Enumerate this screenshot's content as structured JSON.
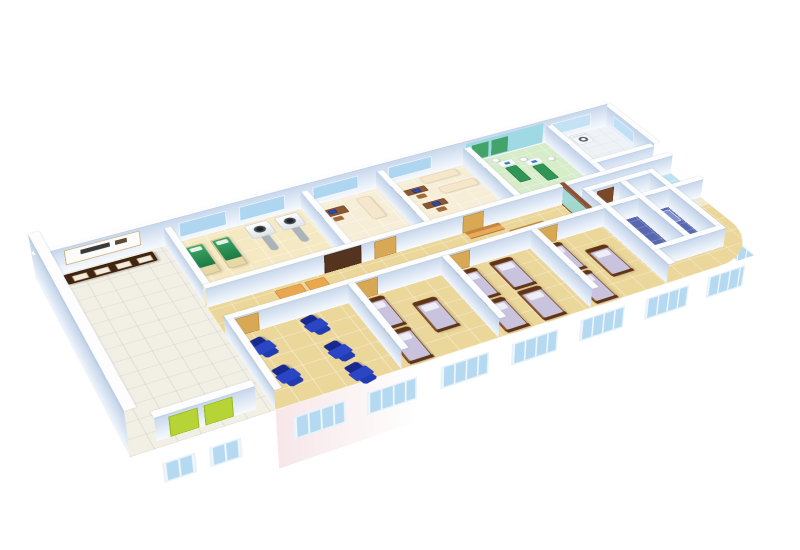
{
  "scene": {
    "background": "#ffffff",
    "camera": {
      "perspective": 1500,
      "rotate_x": 56,
      "rotate_z": -27,
      "scale": 0.88,
      "offset_y": -18,
      "origin": "50% 42%"
    }
  },
  "palette": {
    "wall_top": "#fdfdfe",
    "wall_face_h": [
      "#f8fbff",
      "#c7d7ec"
    ],
    "wall_face_v": [
      "#f2f7fd",
      "#bfd1e8"
    ],
    "floor_tan": "#ecd79b",
    "floor_lobby": "#f2efe4",
    "floor_physio": "#d7ecc9",
    "floor_bath": "#5767b0",
    "glass_blue": "#aed6f0",
    "door_tan": "#d9a855",
    "door_dark": "#54341e",
    "recliner_blue": "#2a46c4",
    "bed_wood": "#8a5a33",
    "bed_mattress": "#c9c3de",
    "exam_green": "#2f9658",
    "elevator_green": "#b6d435",
    "facade_pink": "#f7e7e9",
    "counter_glass": "#9fc6e6"
  },
  "plan": {
    "width": 760,
    "height": 360,
    "wall_height": 26
  },
  "floors": [
    {
      "name": "floor-main-wing",
      "x": 150,
      "y": 30,
      "w": 610,
      "h": 330,
      "color": "#ecd79b",
      "radius": "0 0 70px 0",
      "grid": {
        "c": "rgba(255,255,255,0.45)",
        "s": 26
      }
    },
    {
      "name": "floor-lobby",
      "x": 0,
      "y": 30,
      "w": 150,
      "h": 330,
      "color": "#f2efe4",
      "grid": {
        "c": "rgba(160,170,185,0.25)",
        "s": 24
      }
    },
    {
      "name": "floor-treatment-room",
      "x": 150,
      "y": 30,
      "w": 170,
      "h": 133,
      "color": "#f5e9c4",
      "grid": {
        "c": "rgba(255,255,255,0.5)",
        "s": 24
      }
    },
    {
      "name": "floor-consult-office",
      "x": 320,
      "y": 30,
      "w": 100,
      "h": 133,
      "color": "#f7eed8",
      "grid": {
        "c": "rgba(255,255,255,0.5)",
        "s": 24
      }
    },
    {
      "name": "floor-exam-room",
      "x": 420,
      "y": 30,
      "w": 120,
      "h": 133,
      "color": "#f7eed8",
      "grid": {
        "c": "rgba(255,255,255,0.5)",
        "s": 24
      }
    },
    {
      "name": "floor-physio-room",
      "x": 540,
      "y": 30,
      "w": 120,
      "h": 133,
      "color": "#d7ecc9",
      "grid": {
        "c": "rgba(255,255,255,0.5)",
        "s": 22
      }
    },
    {
      "name": "floor-lab-room",
      "x": 660,
      "y": 30,
      "w": 100,
      "h": 105,
      "color": "#eff3f6",
      "grid": {
        "c": "rgba(200,210,220,0.35)",
        "s": 20
      }
    },
    {
      "name": "floor-reception-lobby",
      "x": 660,
      "y": 135,
      "w": 100,
      "h": 115,
      "color": "#f0e9cf",
      "grid": {
        "c": "rgba(255,255,255,0.5)",
        "s": 22
      }
    },
    {
      "name": "floor-glass-bay",
      "x": 712,
      "y": 148,
      "w": 48,
      "h": 104,
      "color": "#bfe2f4",
      "radius": "0 30px 70px 0",
      "grid": {
        "c": "rgba(255,255,255,0.5)",
        "s": 16
      }
    },
    {
      "name": "floor-bathrooms",
      "x": 620,
      "y": 185,
      "w": 100,
      "h": 145,
      "color": "#5767b0",
      "grid": {
        "c": "rgba(255,255,255,0.28)",
        "s": 15
      }
    }
  ],
  "walls": [
    {
      "n": "wall-exterior-left",
      "o": "v",
      "u": 0,
      "v": 30,
      "len": 330,
      "t": 12,
      "H": 58
    },
    {
      "n": "wall-exterior-back",
      "o": "h",
      "u": 0,
      "v": 30,
      "len": 752,
      "t": 8,
      "H": 34
    },
    {
      "n": "wall-lobby-right-upper",
      "o": "v",
      "u": 150,
      "v": 30,
      "len": 133
    },
    {
      "n": "wall-lobby-right-lower",
      "o": "v",
      "u": 150,
      "v": 225,
      "len": 135
    },
    {
      "n": "wall-corridor-back",
      "o": "h",
      "u": 150,
      "v": 163,
      "len": 610,
      "t": 8
    },
    {
      "n": "wall-corridor-front",
      "o": "h",
      "u": 150,
      "v": 225,
      "len": 610,
      "t": 8
    },
    {
      "n": "wall-div-treatment-office",
      "o": "v",
      "u": 320,
      "v": 30,
      "len": 133
    },
    {
      "n": "wall-div-office-exam",
      "o": "v",
      "u": 420,
      "v": 30,
      "len": 133
    },
    {
      "n": "wall-div-exam-physio",
      "o": "v",
      "u": 540,
      "v": 30,
      "len": 133
    },
    {
      "n": "wall-div-physio-lab",
      "o": "v",
      "u": 660,
      "v": 30,
      "len": 133
    },
    {
      "n": "wall-lab-reception",
      "o": "h",
      "u": 660,
      "v": 135,
      "len": 92,
      "t": 8
    },
    {
      "n": "wall-exterior-right",
      "o": "v",
      "u": 752,
      "v": 30,
      "len": 113,
      "H": 30
    },
    {
      "n": "wall-div-infusion-ward1",
      "o": "v",
      "u": 290,
      "v": 233,
      "len": 127
    },
    {
      "n": "wall-div-ward1-ward2",
      "o": "v",
      "u": 405,
      "v": 233,
      "len": 127
    },
    {
      "n": "wall-div-ward2-ward3",
      "o": "v",
      "u": 520,
      "v": 233,
      "len": 127
    },
    {
      "n": "wall-div-ward3-bath",
      "o": "v",
      "u": 620,
      "v": 185,
      "len": 175
    },
    {
      "n": "wall-bath-back",
      "o": "h",
      "u": 620,
      "v": 185,
      "len": 100,
      "t": 8
    },
    {
      "n": "wall-bath-divider",
      "o": "v",
      "u": 668,
      "v": 193,
      "len": 137
    },
    {
      "n": "wall-bath-right",
      "o": "v",
      "u": 712,
      "v": 185,
      "len": 145
    },
    {
      "n": "wall-bath-front",
      "o": "h",
      "u": 620,
      "v": 322,
      "len": 100,
      "t": 8
    },
    {
      "n": "wall-corridor-glass-door",
      "o": "v",
      "u": 602,
      "v": 163,
      "len": 62,
      "t": 6,
      "glass": true
    },
    {
      "n": "wall-elevator-shaft",
      "o": "h",
      "u": 30,
      "v": 340,
      "len": 104,
      "t": 10,
      "H": 30
    }
  ],
  "openings": [
    {
      "n": "window-treatment-1",
      "on": "h",
      "u": 168,
      "v": 38.4,
      "len": 58,
      "z0": 6,
      "z1": 26,
      "color": "#aed6f0",
      "frame": "#f6fbff"
    },
    {
      "n": "window-treatment-2",
      "on": "h",
      "u": 242,
      "v": 38.4,
      "len": 58,
      "z0": 6,
      "z1": 26,
      "color": "#aed6f0",
      "frame": "#f6fbff"
    },
    {
      "n": "window-office",
      "on": "h",
      "u": 336,
      "v": 38.4,
      "len": 60,
      "z0": 8,
      "z1": 26,
      "color": "#aed6f0",
      "frame": "#f6fbff"
    },
    {
      "n": "window-exam",
      "on": "h",
      "u": 436,
      "v": 38.4,
      "len": 60,
      "z0": 8,
      "z1": 26,
      "color": "#aed6f0",
      "frame": "#f6fbff"
    },
    {
      "n": "glass-band-physio",
      "on": "h",
      "u": 544,
      "v": 38.4,
      "len": 112,
      "z0": 2,
      "z1": 30,
      "color": "#9ed9e4"
    },
    {
      "n": "green-panel-physio-1",
      "on": "h",
      "u": 552,
      "v": 38.7,
      "len": 24,
      "z0": 4,
      "z1": 26,
      "color": "#43a368"
    },
    {
      "n": "green-panel-physio-2",
      "on": "h",
      "u": 580,
      "v": 38.7,
      "len": 24,
      "z0": 4,
      "z1": 26,
      "color": "#43a368"
    },
    {
      "n": "window-lab",
      "on": "h",
      "u": 668,
      "v": 38.4,
      "len": 60,
      "z0": 8,
      "z1": 26,
      "color": "#c4e2f4",
      "frame": "#f6fbff"
    },
    {
      "n": "sign-registration",
      "on": "h",
      "u": 34,
      "v": 38.4,
      "len": 88,
      "z0": 10,
      "z1": 30,
      "color": "#fbfbf9",
      "frame": "#caa86a"
    },
    {
      "n": "sign-text-mark-1",
      "on": "h",
      "u": 52,
      "v": 38.8,
      "len": 34,
      "z0": 20,
      "z1": 26,
      "color": "#3a3a3a"
    },
    {
      "n": "sign-text-mark-2",
      "on": "h",
      "u": 92,
      "v": 38.8,
      "len": 14,
      "z0": 20,
      "z1": 26,
      "color": "#5a4a3a"
    },
    {
      "n": "door-treatment-double",
      "on": "h",
      "u": 290,
      "v": 171.4,
      "len": 46,
      "z0": 0,
      "z1": 25,
      "color": "#54341e",
      "frame": "#3c2412"
    },
    {
      "n": "door-office",
      "on": "h",
      "u": 352,
      "v": 171.4,
      "len": 28,
      "z0": 0,
      "z1": 24,
      "color": "#d9a855",
      "frame": "#b8863c"
    },
    {
      "n": "door-exam",
      "on": "h",
      "u": 466,
      "v": 171.4,
      "len": 28,
      "z0": 0,
      "z1": 24,
      "color": "#d9a855",
      "frame": "#b8863c"
    },
    {
      "n": "door-infusion",
      "on": "h",
      "u": 158,
      "v": 233.4,
      "len": 28,
      "z0": 0,
      "z1": 24,
      "color": "#d9a855",
      "frame": "#b8863c"
    },
    {
      "n": "door-ward1",
      "on": "h",
      "u": 298,
      "v": 233.4,
      "len": 28,
      "z0": 0,
      "z1": 24,
      "color": "#d9a855",
      "frame": "#b8863c"
    },
    {
      "n": "door-ward2",
      "on": "h",
      "u": 413,
      "v": 233.4,
      "len": 28,
      "z0": 0,
      "z1": 24,
      "color": "#d9a855",
      "frame": "#b8863c"
    },
    {
      "n": "door-ward3",
      "on": "h",
      "u": 528,
      "v": 233.4,
      "len": 28,
      "z0": 0,
      "z1": 24,
      "color": "#d9a855",
      "frame": "#b8863c"
    },
    {
      "n": "door-bathroom",
      "on": "h",
      "u": 636,
      "v": 193.4,
      "len": 24,
      "z0": 0,
      "z1": 22,
      "color": "#7a4a28",
      "frame": "#5e3418"
    },
    {
      "n": "door-elevator-left",
      "on": "h",
      "u": 44,
      "v": 350.4,
      "len": 30,
      "z0": 0,
      "z1": 26,
      "color": "#b6d435",
      "frame": "#8fb313"
    },
    {
      "n": "door-elevator-right",
      "on": "h",
      "u": 80,
      "v": 350.4,
      "len": 30,
      "z0": 0,
      "z1": 26,
      "color": "#b6d435",
      "frame": "#8fb313"
    },
    {
      "n": "glass-panel-lobby-1",
      "on": "v",
      "u": 12.4,
      "v": 150,
      "len": 48,
      "z0": 6,
      "z1": 40,
      "color": "#b7d2e8",
      "frame": "#6e4226"
    },
    {
      "n": "glass-panel-lobby-2",
      "on": "v",
      "u": 12.4,
      "v": 204,
      "len": 48,
      "z0": 6,
      "z1": 40,
      "color": "#b7d2e8",
      "frame": "#6e4226"
    },
    {
      "n": "glass-panel-lobby-3",
      "on": "v",
      "u": 12.4,
      "v": 258,
      "len": 48,
      "z0": 6,
      "z1": 40,
      "color": "#b7d2e8",
      "frame": "#6e4226"
    },
    {
      "n": "window-lab-right",
      "on": "v",
      "u": 752.4,
      "v": 54,
      "len": 46,
      "z0": 8,
      "z1": 24,
      "color": "#bfe0f6",
      "frame": "#f6fbff"
    }
  ],
  "facades": [
    {
      "n": "facade-front-main",
      "type": "h",
      "u": 150,
      "v": 360,
      "len": 610,
      "depth": 78,
      "bg": "linear-gradient(90deg,#f7e7e9 0%,#ffffff 26%,#ffffff 100%)",
      "win_color": "#b4d9f1",
      "win_frame": "#e8f2fa",
      "windows": [
        {
          "x": 18,
          "d": 16,
          "w": 58,
          "h": 30
        },
        {
          "x": 100,
          "d": 16,
          "w": 58,
          "h": 30
        },
        {
          "x": 186,
          "d": 14,
          "w": 58,
          "h": 30
        },
        {
          "x": 272,
          "d": 14,
          "w": 58,
          "h": 30
        },
        {
          "x": 358,
          "d": 12,
          "w": 58,
          "h": 30
        },
        {
          "x": 444,
          "d": 12,
          "w": 58,
          "h": 30
        },
        {
          "x": 528,
          "d": 10,
          "w": 52,
          "h": 30
        }
      ]
    },
    {
      "n": "facade-front-lobby",
      "type": "h",
      "u": 0,
      "v": 360,
      "len": 150,
      "depth": 78,
      "bg": "#ffffff",
      "win_color": "#b4d9f1",
      "win_frame": "#e8f2fa",
      "windows": [
        {
          "x": 30,
          "d": 20,
          "w": 34,
          "h": 26
        },
        {
          "x": 78,
          "d": 20,
          "w": 34,
          "h": 26
        }
      ]
    },
    {
      "n": "facade-right-end",
      "type": "v",
      "u": 760,
      "v": 135,
      "len": 225,
      "depth": 78,
      "bg": "#ffffff",
      "win_color": "#b4d9f1",
      "win_frame": "#e8f2fa",
      "windows": [
        {
          "y": 24,
          "d": 14,
          "w": 48,
          "h": 28
        },
        {
          "y": 96,
          "d": 14,
          "w": 48,
          "h": 28
        },
        {
          "y": 168,
          "d": 18,
          "w": 40,
          "h": 26
        }
      ]
    }
  ],
  "furniture": [
    {
      "t": "counter",
      "n": "registration-counter",
      "x": 28,
      "y": 44
    },
    {
      "t": "gbed",
      "n": "exam-bed-green-1",
      "x": 166,
      "y": 54
    },
    {
      "t": "gbed",
      "n": "exam-bed-green-2",
      "x": 198,
      "y": 54
    },
    {
      "t": "scan",
      "n": "scanner-machine-1",
      "x": 244,
      "y": 44
    },
    {
      "t": "scan",
      "n": "scanner-machine-2",
      "x": 282,
      "y": 44
    },
    {
      "t": "desk",
      "n": "doctor-desk",
      "x": 330,
      "y": 56
    },
    {
      "t": "couch",
      "n": "exam-couch-office",
      "x": 386,
      "y": 50,
      "vert": true
    },
    {
      "t": "box",
      "n": "cabinet",
      "x": 424,
      "y": 44,
      "w": 14,
      "h": 66,
      "color": "#b5834e",
      "border": "#8f5f30"
    },
    {
      "t": "desk",
      "n": "pc-desk-1",
      "x": 444,
      "y": 60,
      "small": true
    },
    {
      "t": "desk",
      "n": "pc-desk-2",
      "x": 452,
      "y": 96,
      "small": true
    },
    {
      "t": "couch",
      "n": "exam-couch-1",
      "x": 476,
      "y": 42
    },
    {
      "t": "couch",
      "n": "exam-couch-2",
      "x": 486,
      "y": 72
    },
    {
      "t": "box",
      "n": "floor-mat",
      "x": 424,
      "y": 120,
      "w": 16,
      "h": 10,
      "color": "#7cc87c"
    },
    {
      "t": "ptable",
      "n": "physio-table-1",
      "x": 550,
      "y": 50
    },
    {
      "t": "ptable",
      "n": "physio-table-2",
      "x": 582,
      "y": 62
    },
    {
      "t": "ptable",
      "n": "physio-table-3",
      "x": 614,
      "y": 74
    },
    {
      "t": "staff",
      "n": "staff-figure-1",
      "x": 576,
      "y": 44
    },
    {
      "t": "staff",
      "n": "staff-figure-2",
      "x": 608,
      "y": 58
    },
    {
      "t": "staff",
      "n": "staff-figure-3",
      "x": 640,
      "y": 72
    },
    {
      "t": "washer",
      "n": "sterilizer-1",
      "x": 666,
      "y": 40
    },
    {
      "t": "washer",
      "n": "sterilizer-2",
      "x": 694,
      "y": 40
    },
    {
      "t": "lcounter",
      "n": "reception-curved-counter",
      "x": 664,
      "y": 166
    },
    {
      "t": "box",
      "n": "corridor-table-1",
      "x": 226,
      "y": 178,
      "w": 32,
      "h": 18,
      "color": "#eaa84e",
      "border": "#c8883a"
    },
    {
      "t": "box",
      "n": "corridor-table-2",
      "x": 262,
      "y": 178,
      "w": 24,
      "h": 18,
      "color": "#eaa84e",
      "border": "#c8883a"
    },
    {
      "t": "bench",
      "n": "corridor-bench-1",
      "x": 468,
      "y": 172
    },
    {
      "t": "bench",
      "n": "corridor-bench-2",
      "x": 516,
      "y": 192
    },
    {
      "t": "recliner",
      "n": "infusion-recliner-1",
      "x": 166,
      "y": 246,
      "rot": -14
    },
    {
      "t": "recliner",
      "n": "infusion-recliner-2",
      "x": 170,
      "y": 300,
      "rot": -14
    },
    {
      "t": "recliner",
      "n": "infusion-recliner-3",
      "x": 230,
      "y": 236,
      "rot": -14
    },
    {
      "t": "recliner",
      "n": "infusion-recliner-4",
      "x": 234,
      "y": 288,
      "rot": -14
    },
    {
      "t": "recliner",
      "n": "infusion-recliner-5",
      "x": 238,
      "y": 330,
      "rot": -14
    },
    {
      "t": "bed",
      "n": "ward1-bed-1",
      "x": 300,
      "y": 238
    },
    {
      "t": "bed",
      "n": "ward1-bed-2",
      "x": 300,
      "y": 300
    },
    {
      "t": "bed",
      "n": "ward1-bed-3",
      "x": 350,
      "y": 266
    },
    {
      "t": "bed",
      "n": "ward2-bed-1",
      "x": 416,
      "y": 238
    },
    {
      "t": "bed",
      "n": "ward2-bed-2",
      "x": 416,
      "y": 300
    },
    {
      "t": "bed",
      "n": "ward2-bed-3",
      "x": 462,
      "y": 238
    },
    {
      "t": "bed",
      "n": "ward2-bed-4",
      "x": 462,
      "y": 300
    },
    {
      "t": "bed",
      "n": "ward3-bed-1",
      "x": 528,
      "y": 238
    },
    {
      "t": "bed",
      "n": "ward3-bed-2",
      "x": 528,
      "y": 300
    },
    {
      "t": "bed",
      "n": "ward3-bed-3",
      "x": 572,
      "y": 266
    },
    {
      "t": "toilet",
      "n": "toilet-1",
      "x": 634,
      "y": 212
    },
    {
      "t": "toilet",
      "n": "toilet-2",
      "x": 688,
      "y": 202
    },
    {
      "t": "box",
      "n": "shower-tray",
      "x": 682,
      "y": 240,
      "w": 26,
      "h": 26,
      "color": "#7d90cc",
      "border": "#ffffff"
    }
  ]
}
